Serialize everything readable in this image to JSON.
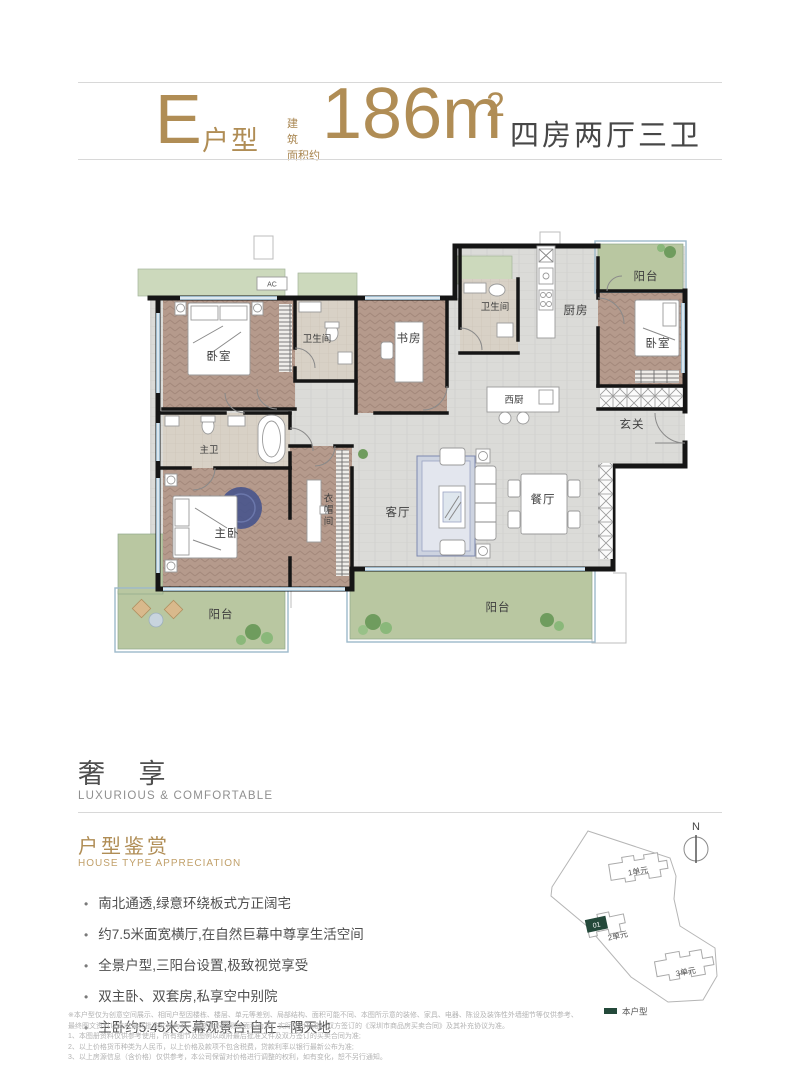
{
  "header": {
    "type_letter": "E",
    "type_suffix": "户型",
    "area_prefix_line1": "建 筑",
    "area_prefix_line2": "面积约",
    "area_value": "186m",
    "area_sup": "2",
    "spec": "四房两厅三卫"
  },
  "plan": {
    "rooms": {
      "bedroom_top_left": "卧室",
      "bath_guest": "卫生间",
      "study": "书房",
      "bath_second": "卫生间",
      "kitchen": "厨房",
      "balcony_top": "阳台",
      "bedroom_right": "卧室",
      "west_kitchen": "西厨",
      "foyer": "玄关",
      "master_bath": "主卫",
      "master_bedroom": "主卧",
      "cloakroom": "衣帽间",
      "living_room": "客厅",
      "dining_room": "餐厅",
      "balcony_left": "阳台",
      "balcony_center": "阳台",
      "ac": "AC"
    }
  },
  "section": {
    "title_cn": "奢 享",
    "title_en": "LUXURIOUS & COMFORTABLE",
    "subtitle_cn": "户型鉴赏",
    "subtitle_en": "HOUSE TYPE APPRECIATION",
    "bullets": [
      "南北通透,绿意环绕板式方正阔宅",
      "约7.5米面宽横厅,在自然巨幕中尊享生活空间",
      "全景户型,三阳台设置,极致视觉享受",
      "双主卧、双套房,私享空中别院",
      "主卧约5.45米天幕观景台,自在一隅天地"
    ]
  },
  "disclaimer": {
    "lines": [
      "※本户型仅为创意空间展示、相同户型因楼栋、楼层、单元等差别、局部结构、面积可能不同、本图所示意的装修、家具、电器、陈设及装饰性外墙细节等仅供参考、",
      "最终图文资料以政府最终批准文件为准、最终面积以测绘面积为准、实际交付标准以双方签订的《深圳市商品房买卖合同》及其补充协议为准。",
      "1、本图册资料仅供参考使用，所有细节及图例以政府最后批准文件及双方签订的买卖合同为准;",
      "2、以上价格货币种类为人民币，以上价格及款项不包含税费，贷款利率以银行最新公布为准;",
      "3、以上房源信息（含价格）仅供参考，本公司保留对价格进行调整的权利，如有变化，恕不另行通知。"
    ]
  },
  "siteplan": {
    "north": "N",
    "units": {
      "u1": "1单元",
      "u2": "2单元",
      "u3": "3单元"
    },
    "highlight": "01",
    "legend": "本户型"
  },
  "colors": {
    "accent_gold": "#b08d55",
    "text_dark": "#474747",
    "wall": "#151515",
    "wood_floor": "#b59a8c",
    "gray_floor": "#dbdbd8",
    "bath_floor": "#d8d1c6",
    "balcony_green": "#b9c7a1",
    "window_blue": "#9db9cb",
    "rug_blue": "#47548c",
    "site_green": "#24493a"
  }
}
